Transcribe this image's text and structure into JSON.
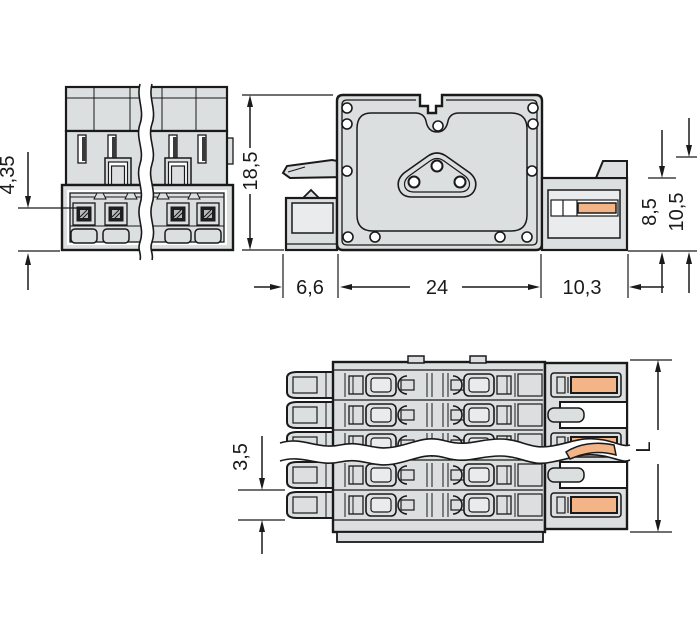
{
  "views": {
    "front": {
      "dims": {
        "contact_offset": "4,35",
        "height": "18,5"
      }
    },
    "side": {
      "dims": {
        "front_depth": "6,6",
        "flange_width": "24",
        "rear_depth": "10,3",
        "body_height": "8,5",
        "overall_height": "10,5"
      }
    },
    "top": {
      "dims": {
        "pole_pitch": "3,5",
        "overall_length": "L"
      }
    }
  },
  "colors": {
    "body": "#dcdfe0",
    "inset": "#e9ebec",
    "outline": "#1a1a1a",
    "contact_orange": "#f3b587",
    "contact_dark": "#1f1f1f",
    "hatch": "#b7bbbd",
    "background": "#ffffff",
    "dimension": "#1a1a1a"
  }
}
